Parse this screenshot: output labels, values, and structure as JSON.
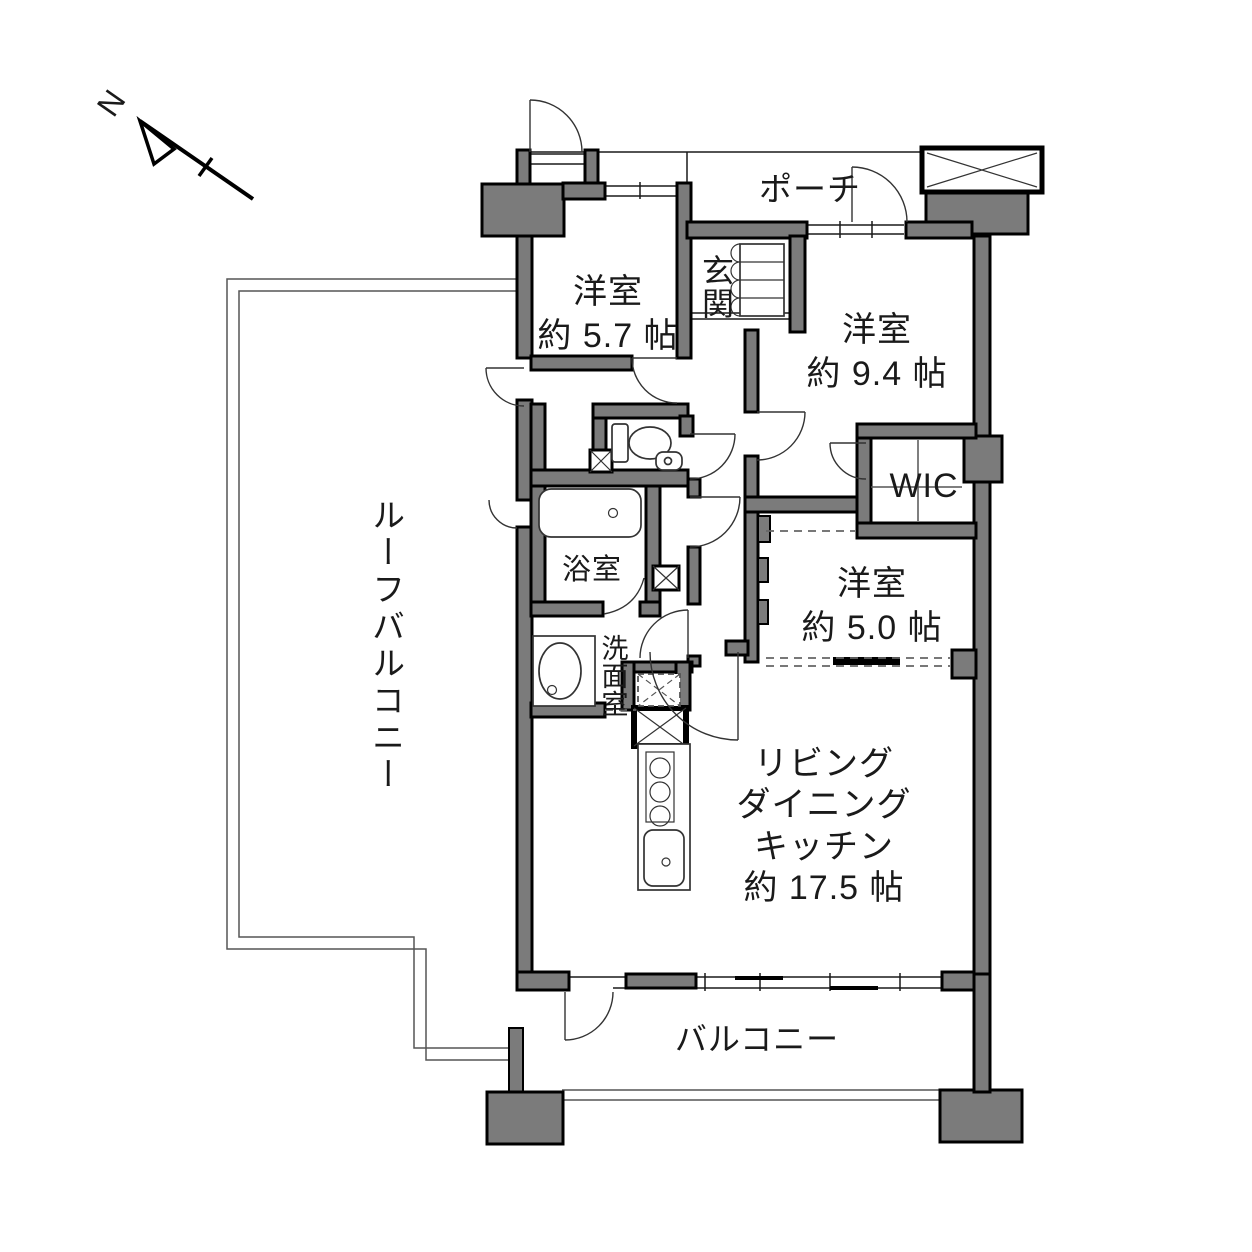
{
  "compass": {
    "label": "N"
  },
  "rooms": {
    "porch": {
      "label": "ポーチ"
    },
    "entrance": {
      "label": "玄関"
    },
    "bedroom_a": {
      "label": "洋室\n約 5.7 帖",
      "name": "洋室",
      "size": "約 5.7 帖"
    },
    "bedroom_b": {
      "label": "洋室\n約 9.4 帖",
      "name": "洋室",
      "size": "約 9.4 帖"
    },
    "wic": {
      "label": "WIC"
    },
    "bedroom_c": {
      "label": "洋室\n約 5.0 帖",
      "name": "洋室",
      "size": "約 5.0 帖"
    },
    "bathroom": {
      "label": "浴室"
    },
    "washroom": {
      "label": "洗面室"
    },
    "ldk": {
      "label": "リビング\nダイニング\nキッチン\n約 17.5 帖",
      "name": "リビングダイニングキッチン",
      "size": "約 17.5 帖"
    },
    "roof_balcony": {
      "label": "ルーフバルコニー"
    },
    "balcony": {
      "label": "バルコニー"
    }
  },
  "colors": {
    "wall_fill": "#7b7b7b",
    "wall_stroke": "#000000",
    "line": "#1a1a1a",
    "background": "#ffffff"
  }
}
